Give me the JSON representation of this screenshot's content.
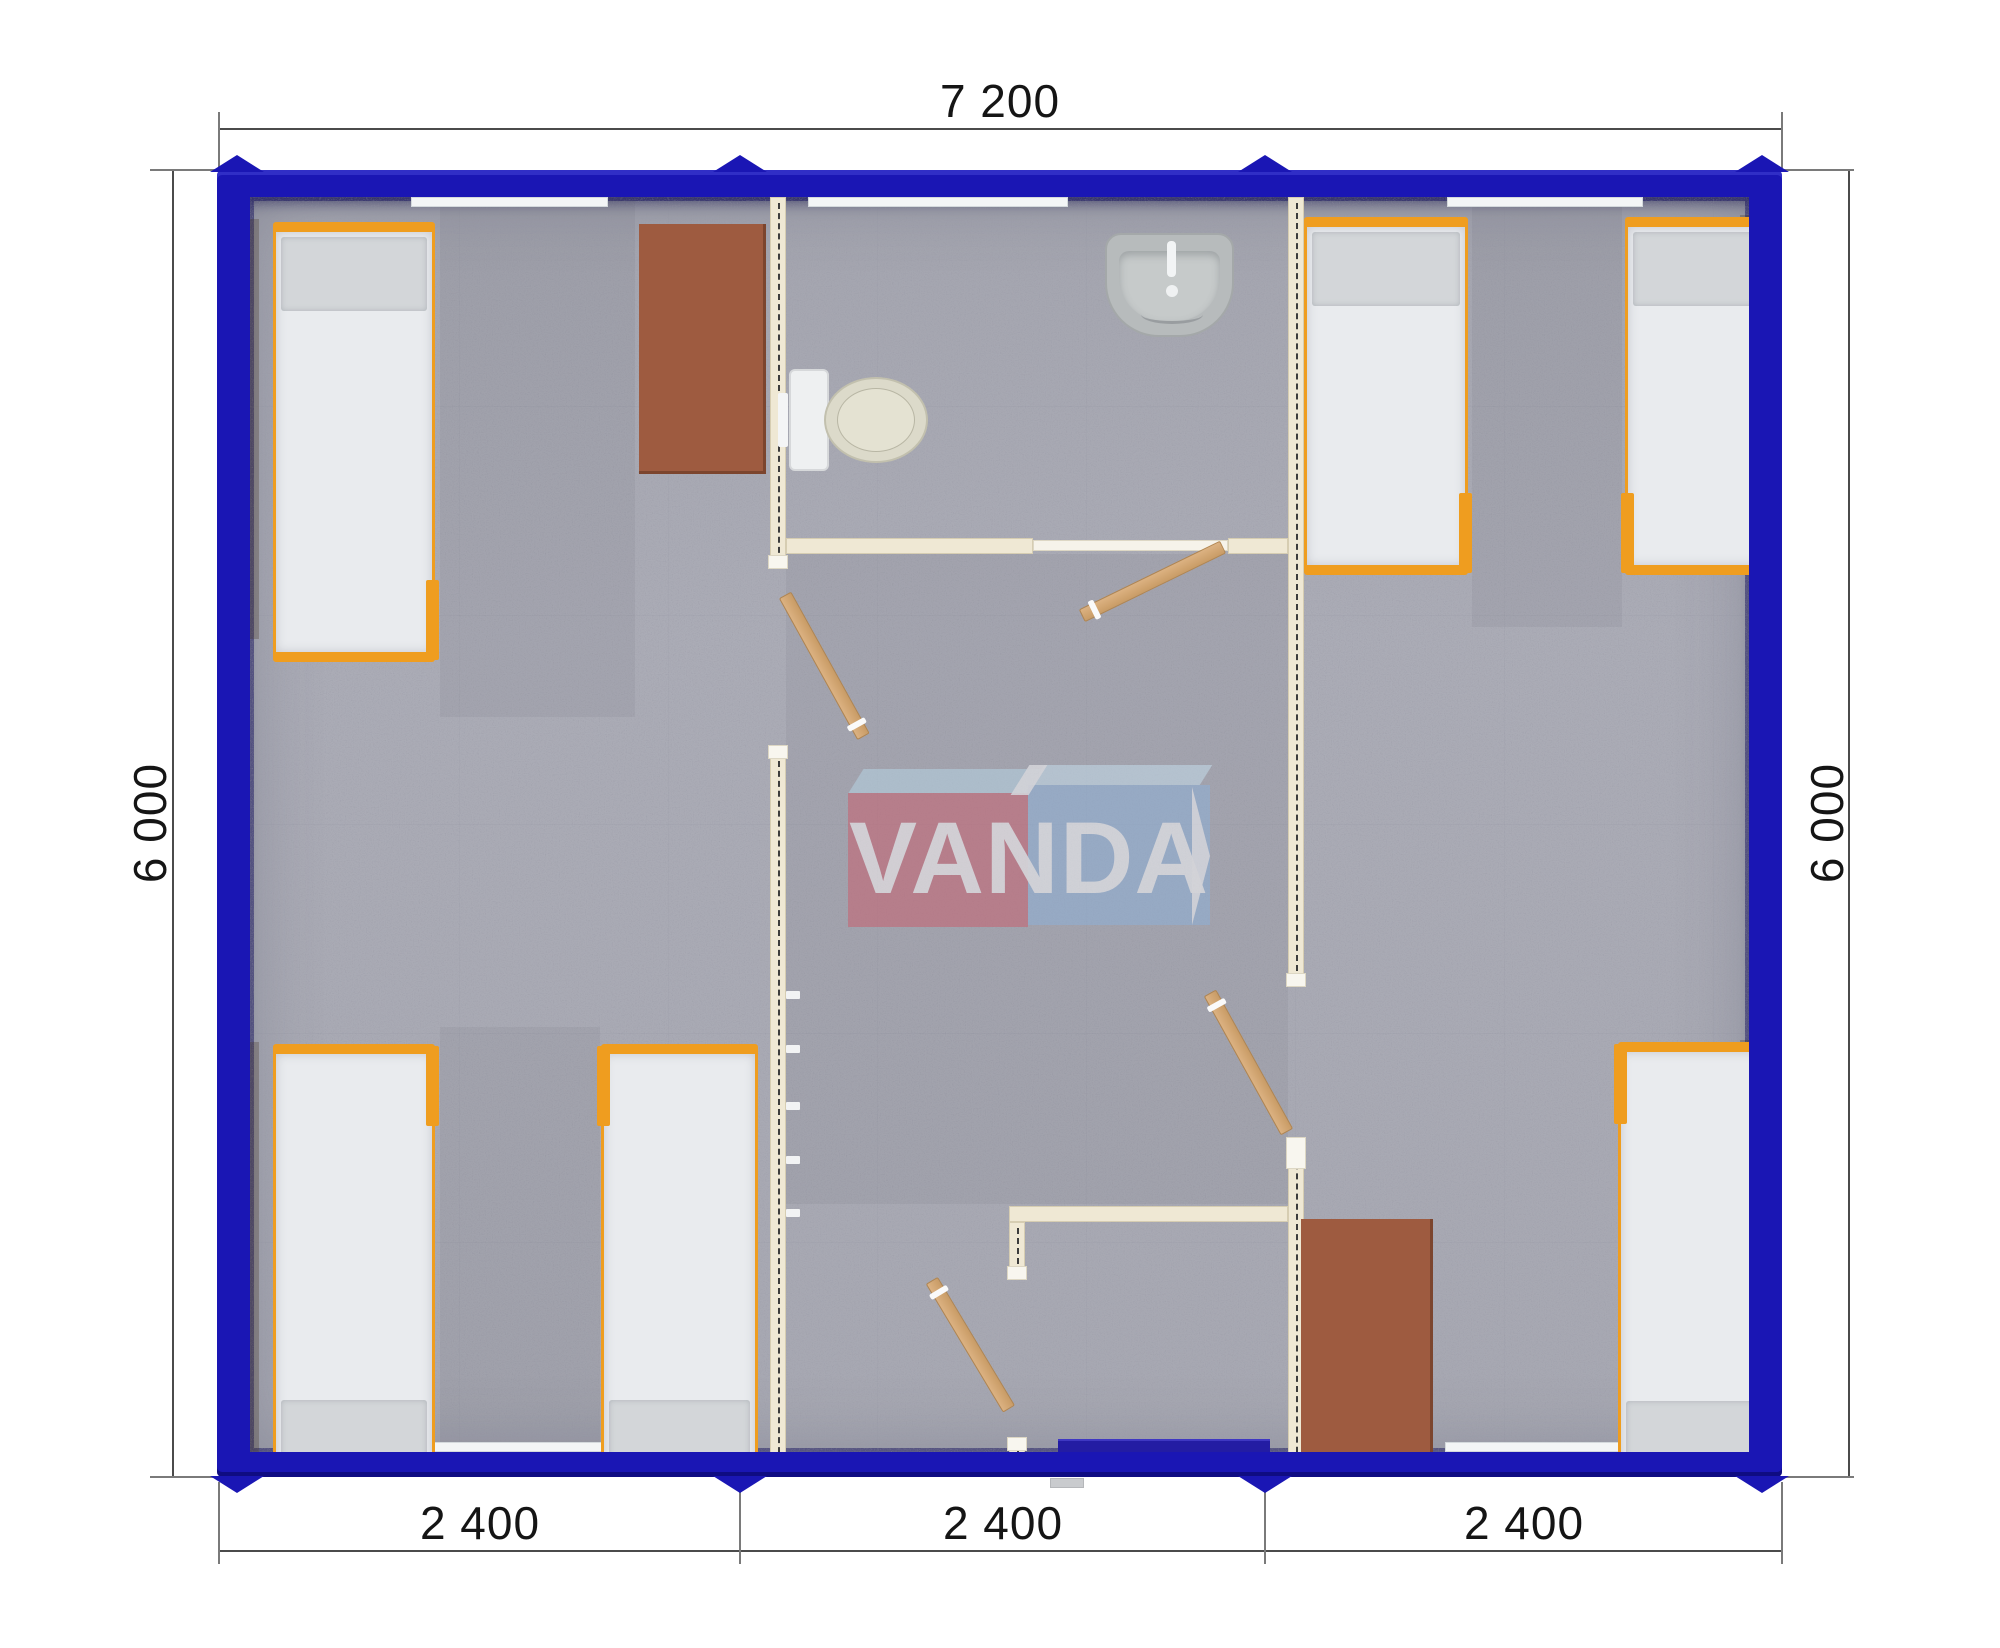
{
  "drawing": {
    "type": "floor-plan-top-view",
    "subject": "modular container building 7200 x 6000 mm, three 2400 mm modules"
  },
  "dimensions": {
    "top": {
      "label": "7 200"
    },
    "bottom": {
      "labels": [
        "2 400",
        "2 400",
        "2 400"
      ]
    },
    "left": {
      "label": "6 000"
    },
    "right": {
      "label": "6 000"
    }
  },
  "watermark": {
    "text": "VANDA",
    "red_box_color": "#ca5e6d",
    "blue_box_color": "#8db1d9",
    "top_face_color": "#bcd9e8"
  },
  "colors": {
    "outer_wall": "#1a16b4",
    "interior_wall": "#efe8d4",
    "floor": "#aaabb5",
    "bed_frame": "#ef9d1f",
    "mattress": "#e9ebee",
    "pillow": "#d3d6d9",
    "desk": "#9e5b40",
    "door_wood": "#d3a873",
    "dimension_text": "#151515"
  },
  "contents": {
    "beds": 6,
    "desks": 2,
    "toilet": 1,
    "sink": 1,
    "interior_doors": 4,
    "entrance_door": 1,
    "windows": 5,
    "coat_hooks": 5
  }
}
